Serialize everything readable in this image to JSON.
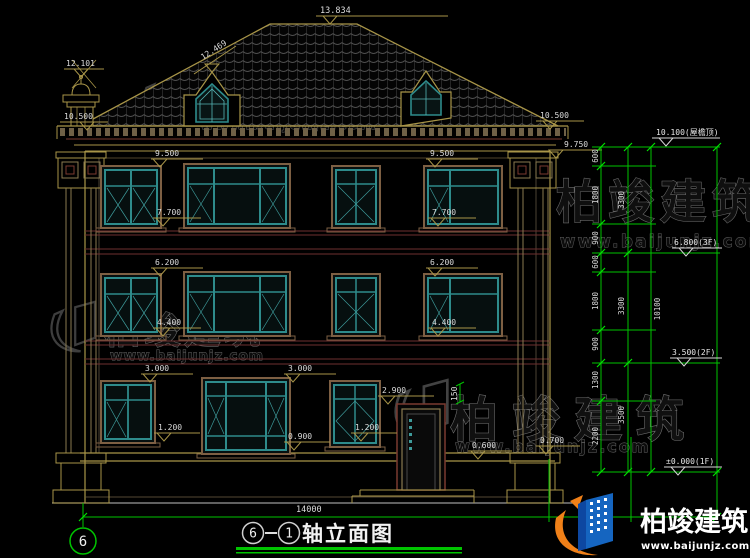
{
  "brand": {
    "name": "柏竣建筑",
    "url": "www.baijunjz.com"
  },
  "title": {
    "axis_a": "6",
    "dash": "—",
    "axis_b": "1",
    "name": "轴立面图",
    "bubble_left": "6"
  },
  "levels": {
    "ridge": "13.834",
    "dormer": "12.469",
    "chimney": "12.101",
    "eave_left": "10.500",
    "eave_right": "10.500",
    "cornice": "9.750",
    "f3_top_left": "9.500",
    "f3_bottom_left": "7.700",
    "f3_top_right": "9.500",
    "f3_bottom_right": "7.700",
    "f2_top_left": "6.200",
    "f2_bottom_left": "4.400",
    "f2_top_right": "6.200",
    "f2_bottom_right": "4.400",
    "f1_top_left": "3.000",
    "f1_top_right": "3.000",
    "f1_bottom_left": "1.200",
    "f1_bottom_center": "1.200",
    "f1_bottom_right": "0.900",
    "door_top": "2.900",
    "canopy_thickness": "150",
    "porch": "0.600",
    "pedestal": "0.700"
  },
  "floor_levels": {
    "roof": "10.100(屋檐顶)",
    "f3": "6.800(3F)",
    "f2": "3.500(2F)",
    "f1": "±0.000(1F)"
  },
  "chain": {
    "col1": [
      "600",
      "1800",
      "900",
      "600",
      "1800",
      "900",
      "1300",
      "2200"
    ],
    "col2": [
      "3300",
      "3300",
      "3500"
    ],
    "col3": "10100",
    "total_width": "14000"
  }
}
